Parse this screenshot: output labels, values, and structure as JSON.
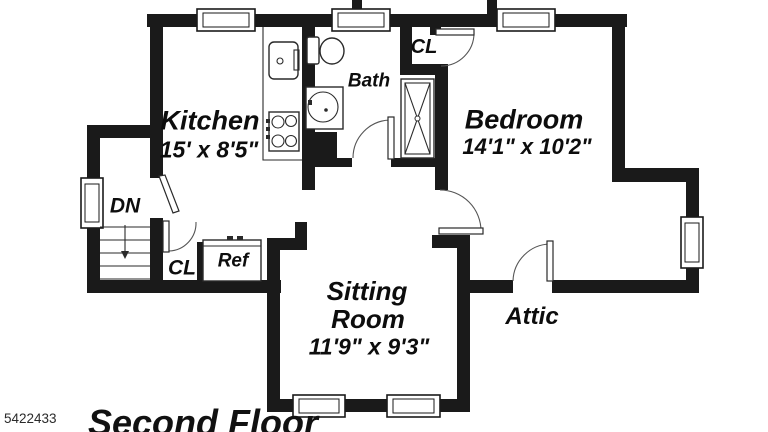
{
  "floorplan": {
    "labels": {
      "kitchen": "Kitchen",
      "kitchen_dims": "15' x 8'5\"",
      "bath": "Bath",
      "closet_top": "CL",
      "bedroom": "Bedroom",
      "bedroom_dims": "14'1\" x 10'2\"",
      "stairs_down": "DN",
      "closet_hall": "CL",
      "refrigerator": "Ref",
      "sitting_line1": "Sitting",
      "sitting_line2": "Room",
      "sitting_dims": "11'9\" x 9'3\"",
      "attic": "Attic"
    },
    "footer": {
      "photo_id": "5422433",
      "title": "Second Floor"
    },
    "colors": {
      "wall": "#1a1a1a",
      "background": "#ffffff",
      "label_text": "#0d0d0d"
    }
  }
}
